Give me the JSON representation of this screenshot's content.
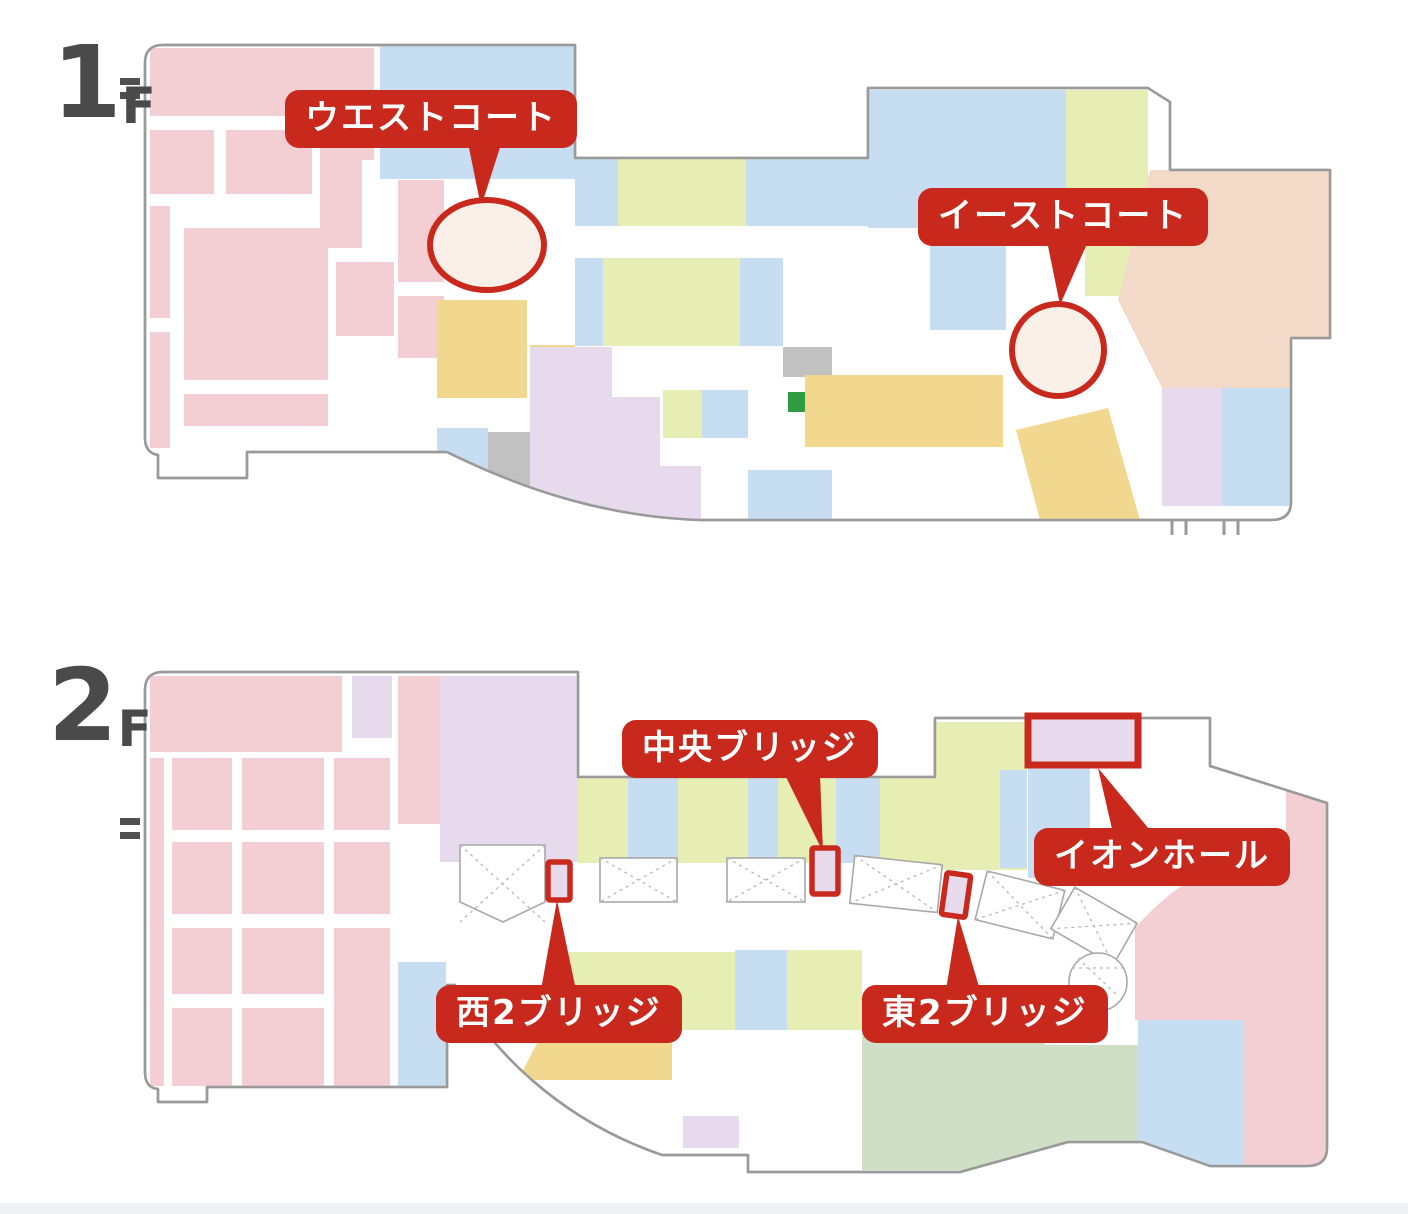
{
  "palette": {
    "red": "#c9291c",
    "pink": "#f3ced3",
    "blue": "#c7ddf1",
    "green": "#e7eeb4",
    "yellow": "#f2d78f",
    "lavender": "#e6daec",
    "peach": "#f3d9c7",
    "sage": "#cfdfc5",
    "gray": "#c1c1c1",
    "bright-green": "#2f9c44",
    "cream": "#faf0e7",
    "outline": "#9a9a9a",
    "ink": "#4a4a4a",
    "footer": "#eef0f3"
  },
  "floors": [
    {
      "id": "1f",
      "number": "1",
      "suffix": "F",
      "labels": {
        "west_court": "ウエストコート",
        "east_court": "イーストコート"
      },
      "markers": [
        {
          "id": "west-court-ellipse",
          "shape": "ellipse"
        },
        {
          "id": "east-court-circle",
          "shape": "circle"
        }
      ]
    },
    {
      "id": "2f",
      "number": "2",
      "suffix": "F",
      "labels": {
        "central_bridge": "中央ブリッジ",
        "aeon_hall": "イオンホール",
        "west2_bridge": "西2ブリッジ",
        "east2_bridge": "東2ブリッジ"
      },
      "markers": [
        {
          "id": "west2-bridge-marker",
          "shape": "rect"
        },
        {
          "id": "central-bridge-marker",
          "shape": "rect"
        },
        {
          "id": "east2-bridge-marker",
          "shape": "rect"
        },
        {
          "id": "aeon-hall-marker",
          "shape": "rect"
        }
      ]
    }
  ]
}
